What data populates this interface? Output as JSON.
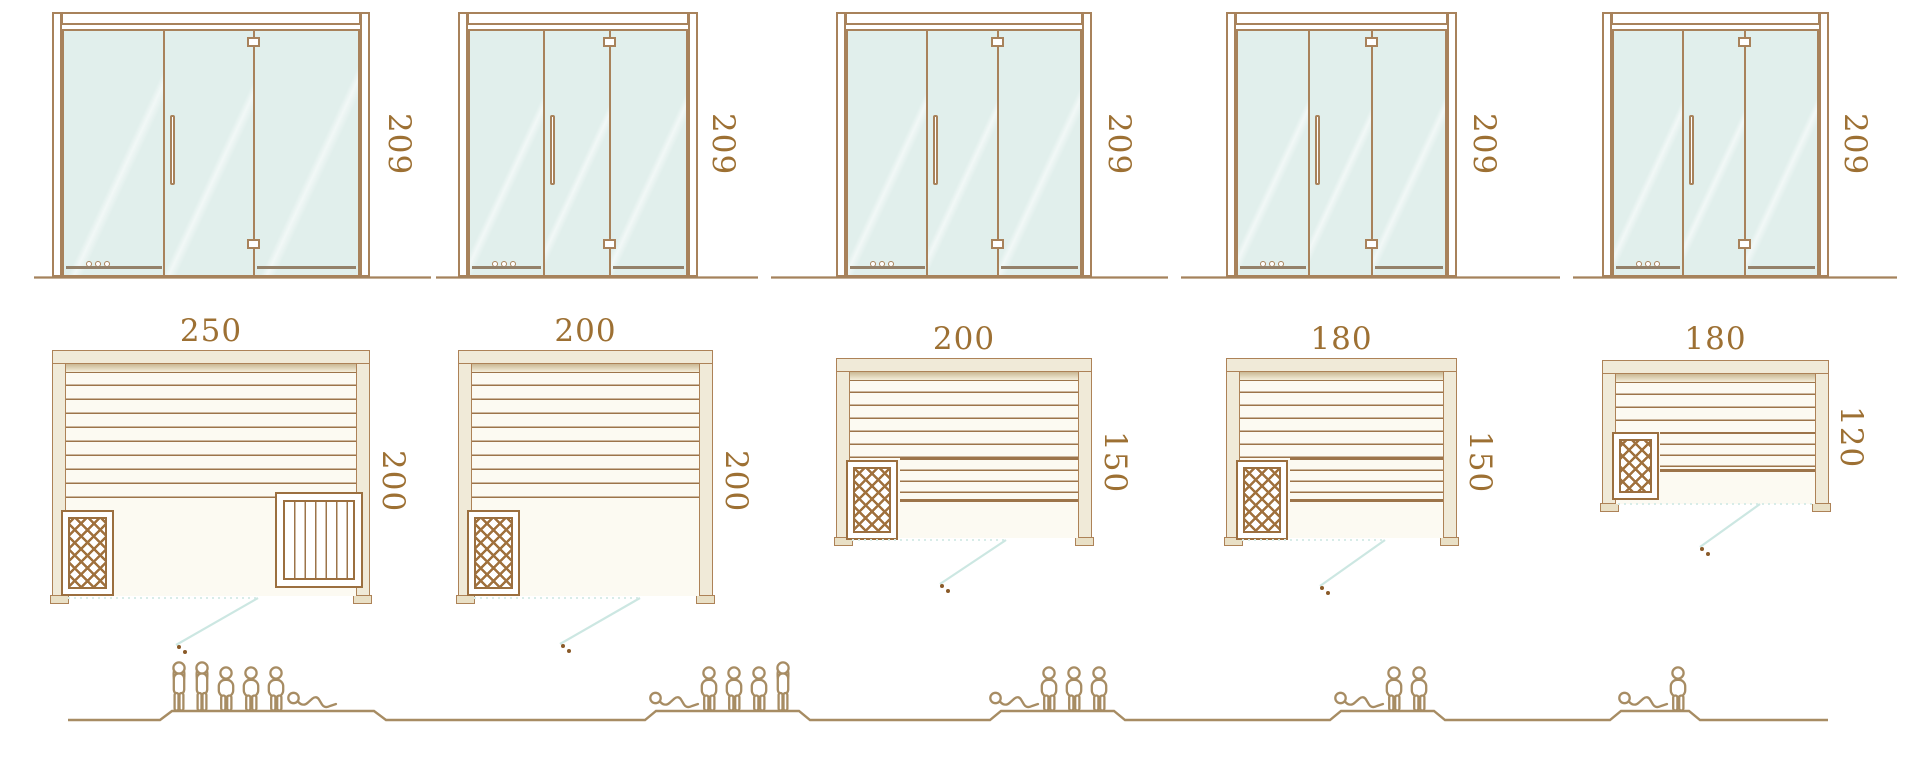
{
  "units": [
    {
      "id": "sauna-250x200",
      "door": {
        "height_label": "209"
      },
      "room": {
        "width_label": "250",
        "depth_label": "200"
      },
      "capacity": {
        "total": 6,
        "figures": [
          "standing",
          "standing",
          "seated",
          "seated",
          "seated",
          "lying"
        ]
      }
    },
    {
      "id": "sauna-200x200",
      "door": {
        "height_label": "209"
      },
      "room": {
        "width_label": "200",
        "depth_label": "200"
      },
      "capacity": {
        "total": 5,
        "figures": [
          "lying",
          "seated",
          "seated",
          "seated",
          "standing"
        ]
      }
    },
    {
      "id": "sauna-200x150",
      "door": {
        "height_label": "209"
      },
      "room": {
        "width_label": "200",
        "depth_label": "150"
      },
      "capacity": {
        "total": 4,
        "figures": [
          "lying",
          "seated",
          "seated",
          "seated"
        ]
      }
    },
    {
      "id": "sauna-180x150",
      "door": {
        "height_label": "209"
      },
      "room": {
        "width_label": "180",
        "depth_label": "150"
      },
      "capacity": {
        "total": 3,
        "figures": [
          "lying",
          "seated",
          "seated"
        ]
      }
    },
    {
      "id": "sauna-180x120",
      "door": {
        "height_label": "209"
      },
      "room": {
        "width_label": "180",
        "depth_label": "120"
      },
      "capacity": {
        "total": 2,
        "figures": [
          "lying",
          "seated"
        ]
      }
    }
  ],
  "colors": {
    "outline_brown": "#a8825b",
    "wood_line": "#9c744a",
    "frame_cream": "#f0ead8",
    "glass_teal": "#e1efec",
    "dimension_text": "#9d7033",
    "people_tan": "#a78c63",
    "floor_teal": "#cfe8e3",
    "lattice_brown": "#9b6f3f"
  }
}
